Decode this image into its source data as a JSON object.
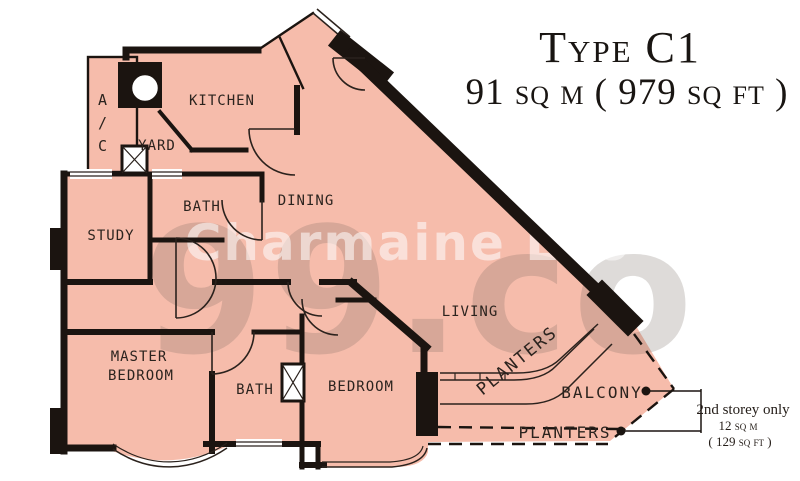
{
  "title": {
    "line1": "Type C1",
    "line2": "91 sq m ( 979 sq ft )"
  },
  "watermark": {
    "name": "Charmaine Lao",
    "brand": "99.co"
  },
  "rooms": {
    "ac_parts": [
      "A",
      "/",
      "C"
    ],
    "yard": "YARD",
    "kitchen": "KITCHEN",
    "bath_upper": "BATH",
    "study": "STUDY",
    "dining": "DINING",
    "living": "LIVING",
    "master_line1": "MASTER",
    "master_line2": "BEDROOM",
    "bath_lower": "BATH",
    "bedroom": "BEDROOM",
    "planters_upper": "PLANTERS",
    "balcony": "BALCONY",
    "planters_lower": "PLANTERS"
  },
  "callout": {
    "line1": "2nd storey only",
    "line2": "12 sq m",
    "line3": "( 129 sq ft )"
  },
  "colors": {
    "floor": "#f6bcab",
    "wall": "#1b1410"
  }
}
